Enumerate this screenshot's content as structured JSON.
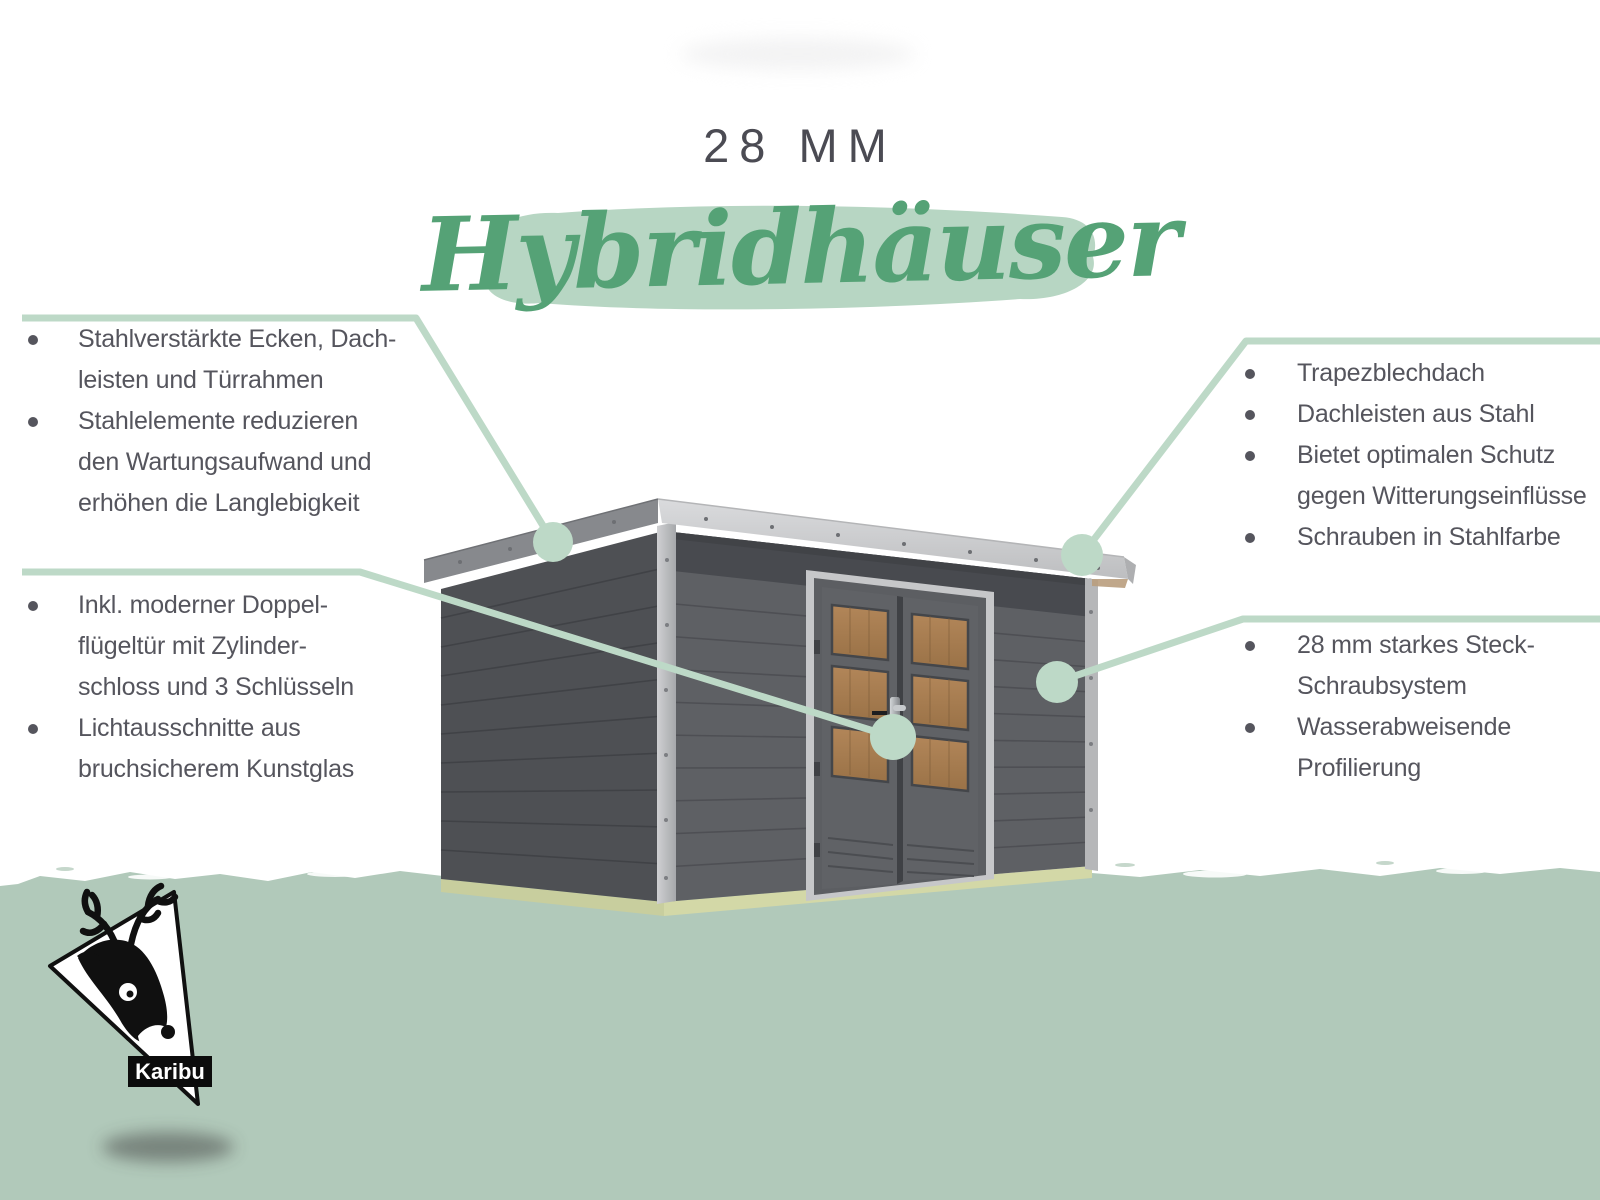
{
  "title": {
    "thickness": "28 MM",
    "range_name": "Hybridhäuser"
  },
  "callouts": {
    "left1": {
      "items": [
        {
          "lines": [
            "Stahlverstärkte Ecken, Dach-",
            "leisten und Türrahmen"
          ]
        },
        {
          "lines": [
            "Stahlelemente reduzieren",
            "den Wartungsaufwand und",
            "erhöhen die Langlebigkeit"
          ]
        }
      ]
    },
    "left2": {
      "items": [
        {
          "lines": [
            "Inkl. moderner Doppel-",
            "flügeltür mit Zylinder-",
            "schloss und 3 Schlüsseln"
          ]
        },
        {
          "lines": [
            "Lichtausschnitte aus",
            "bruchsicherem Kunstglas"
          ]
        }
      ]
    },
    "right1": {
      "items": [
        {
          "lines": [
            "Trapezblechdach"
          ]
        },
        {
          "lines": [
            "Dachleisten aus Stahl"
          ]
        },
        {
          "lines": [
            "Bietet optimalen Schutz",
            "gegen Witterungseinflüsse"
          ]
        },
        {
          "lines": [
            "Schrauben in Stahlfarbe"
          ]
        }
      ]
    },
    "right2": {
      "items": [
        {
          "lines": [
            "28 mm starkes Steck-",
            "Schraubsystem"
          ]
        },
        {
          "lines": [
            "Wasserabweisende",
            "Profilierung"
          ]
        }
      ]
    }
  },
  "logo": {
    "brand": "Karibu"
  },
  "icons": {
    "logo_icon": "karibu-deer-logo",
    "callout_marker": "green-connector-dot"
  },
  "colors": {
    "accent_line_green": "#bdd9c7",
    "highlight_green": "#b7d6c3",
    "title_green": "#55a276",
    "ground_green": "#b1c9ba",
    "text_gray": "#55555d",
    "title_gray": "#4b4b53"
  }
}
